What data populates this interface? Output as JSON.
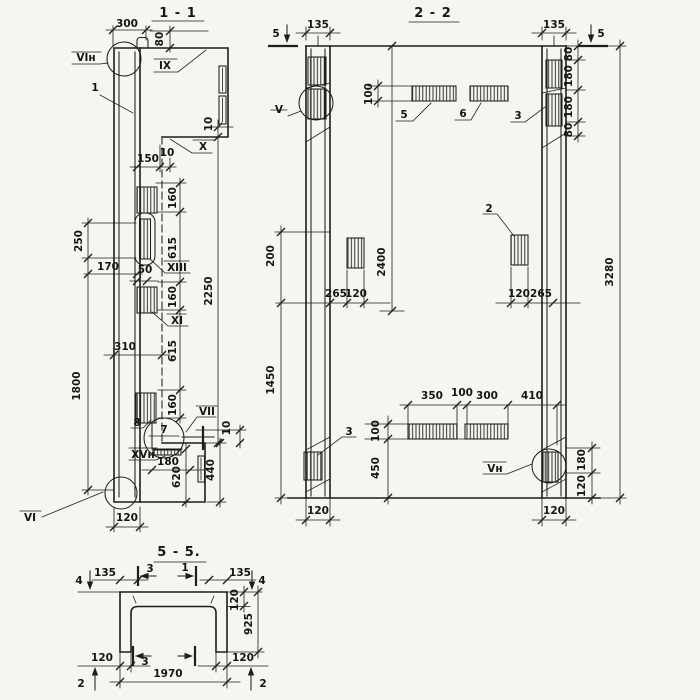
{
  "drawing": {
    "type": "structural reinforced-concrete panel working drawing, three views",
    "colors": {
      "paper": "#f7f5ef",
      "ink": "#1d1d1d"
    }
  },
  "s1": {
    "title": "1 - 1",
    "d300": "300",
    "d80": "80",
    "refVIn": "VIн",
    "ref1": "1",
    "refIX": "IX",
    "refX": "X",
    "d10a": "10",
    "d150": "150",
    "d10b": "10",
    "d160a": "160",
    "d615a": "615",
    "d160b": "160",
    "d615b": "615",
    "d160c": "160",
    "d2250": "2250",
    "d250": "250",
    "d1800": "1800",
    "d170": "170",
    "d50": "50",
    "refXIII": "XIII",
    "refXI": "XI",
    "d310": "310",
    "ref8": "8",
    "ref7": "7",
    "refVII": "VII",
    "refXVn": "XVн",
    "refVI": "VI",
    "d10c": "10",
    "d440": "440",
    "d180": "180",
    "d620": "620",
    "d120": "120"
  },
  "s2": {
    "title": "2 - 2",
    "cutL": "5",
    "cutR": "5",
    "d135l": "135",
    "d135r": "135",
    "d100t": "100",
    "ref5": "5",
    "ref6": "6",
    "ref3t": "3",
    "d80a": "80",
    "d180a": "180",
    "d180b": "180",
    "d80b": "80",
    "d3280": "3280",
    "d2400": "2400",
    "d200": "200",
    "d1450": "1450",
    "d265l": "265",
    "d120l": "120",
    "ref2": "2",
    "d120r": "120",
    "d265r": "265",
    "d350": "350",
    "d100m": "100",
    "d300": "300",
    "d410": "410",
    "d100b": "100",
    "d450": "450",
    "ref3b": "3",
    "refVn": "Vн",
    "d180r": "180",
    "d120rb": "120",
    "d120bl": "120",
    "d120br": "120"
  },
  "s5": {
    "title": "5 - 5.",
    "cut4l": "4",
    "cut4r": "4",
    "cut3t": "3",
    "cut1t": "1",
    "cut3b": "3",
    "cut2l": "2",
    "cut2r": "2",
    "d135l": "135",
    "d135r": "135",
    "d120t": "120",
    "d925": "925",
    "d120bl": "120",
    "d120br": "120",
    "d1970": "1970"
  }
}
